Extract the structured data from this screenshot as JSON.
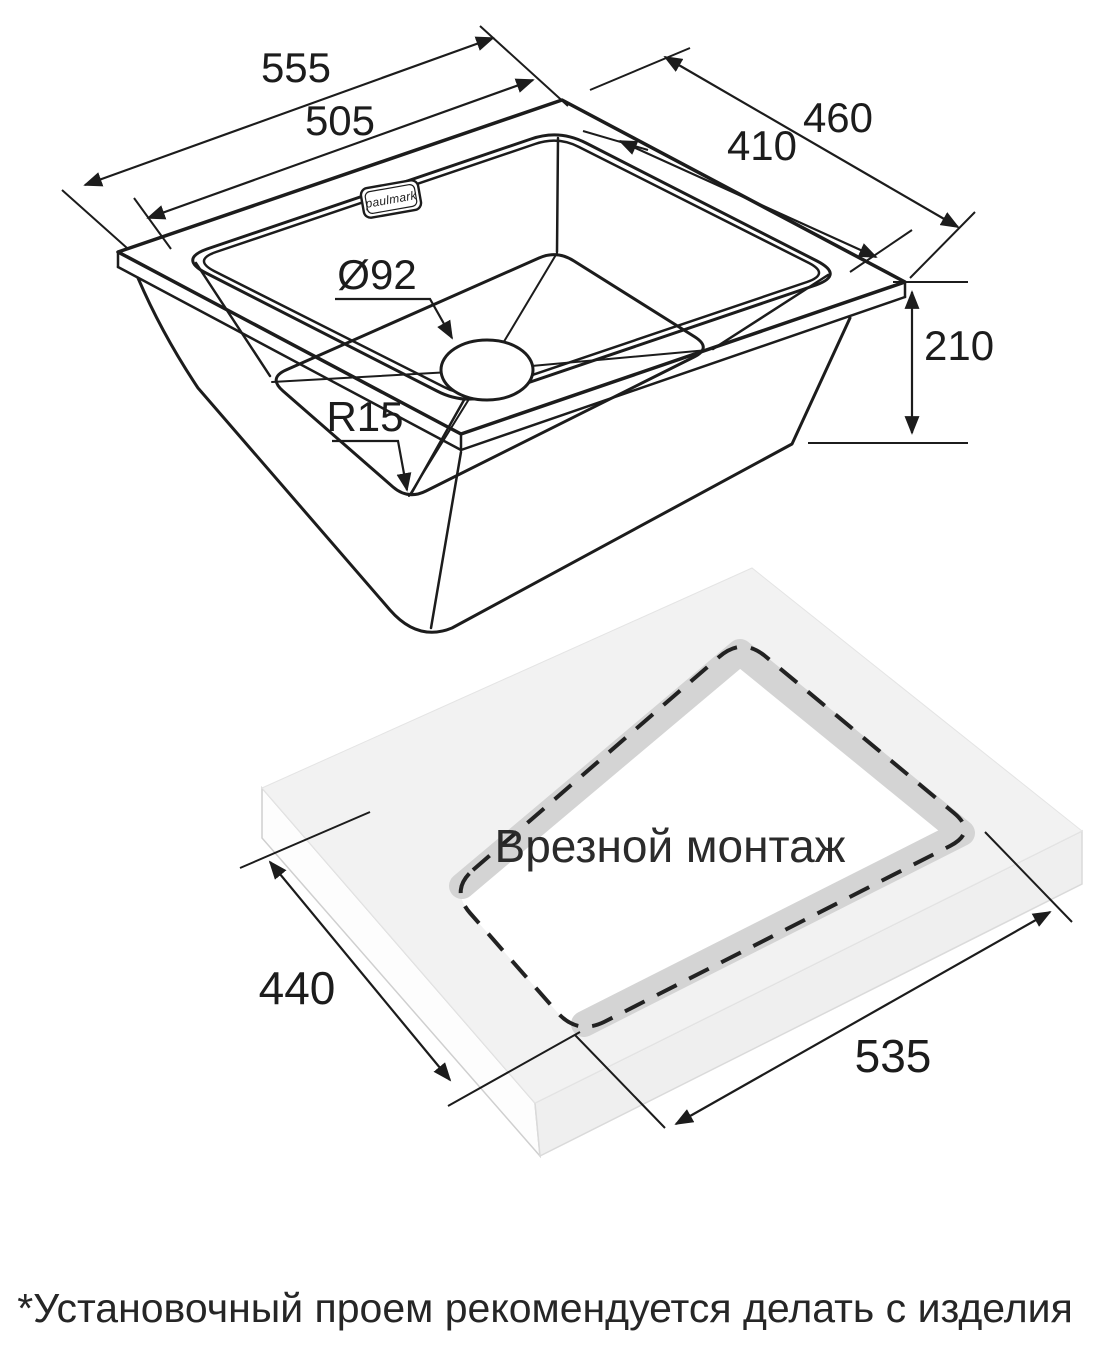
{
  "page": {
    "background": "#ffffff",
    "ink": "#1c1c1c"
  },
  "sink_view": {
    "brand_label": "paulmark",
    "dim_overall_width": "555",
    "dim_bowl_width": "505",
    "dim_overall_depth": "460",
    "dim_bowl_depth": "410",
    "dim_height": "210",
    "dim_drain_diameter": "Ø92",
    "dim_corner_radius": "R15"
  },
  "installation_view": {
    "caption": "Врезной монтаж",
    "dim_cutout_depth": "440",
    "dim_cutout_width": "535",
    "surface_color": "#f2f2f2",
    "wall_color": "#d4d4d4"
  },
  "footnote": "*Установочный проем рекомендуется делать с изделия"
}
